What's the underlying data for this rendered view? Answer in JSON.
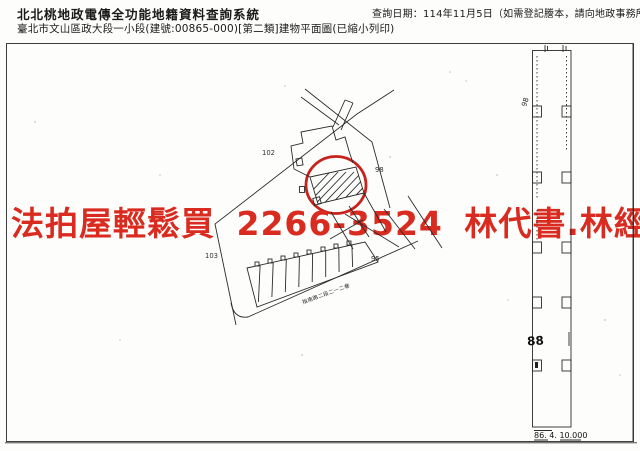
{
  "header": {
    "title": "北北桃地政電傳全功能地籍資料查詢系統",
    "subtitle": "臺北市文山區政大段一小段(建號:00865-000)[第二類]建物平面圖(已縮小列印)",
    "query_date": "查詢日期：114年11月5日（如需登記謄本，請向地政事務所申請。）"
  },
  "watermark": {
    "text": "法拍屋輕鬆買 2266-3524 林代書.林經理",
    "color": "#d92b20"
  },
  "map": {
    "parcel_labels": [
      {
        "text": "102"
      },
      {
        "text": "103"
      },
      {
        "text": "98"
      },
      {
        "text": "95"
      }
    ],
    "road_label": "指南路二段二一二巷",
    "strip_labels": {
      "top": "98",
      "mid": "88",
      "bottom_note": "86. 4. 10.000"
    },
    "line_color": "#2b2b2b",
    "highlight_color": "#c6231c"
  }
}
